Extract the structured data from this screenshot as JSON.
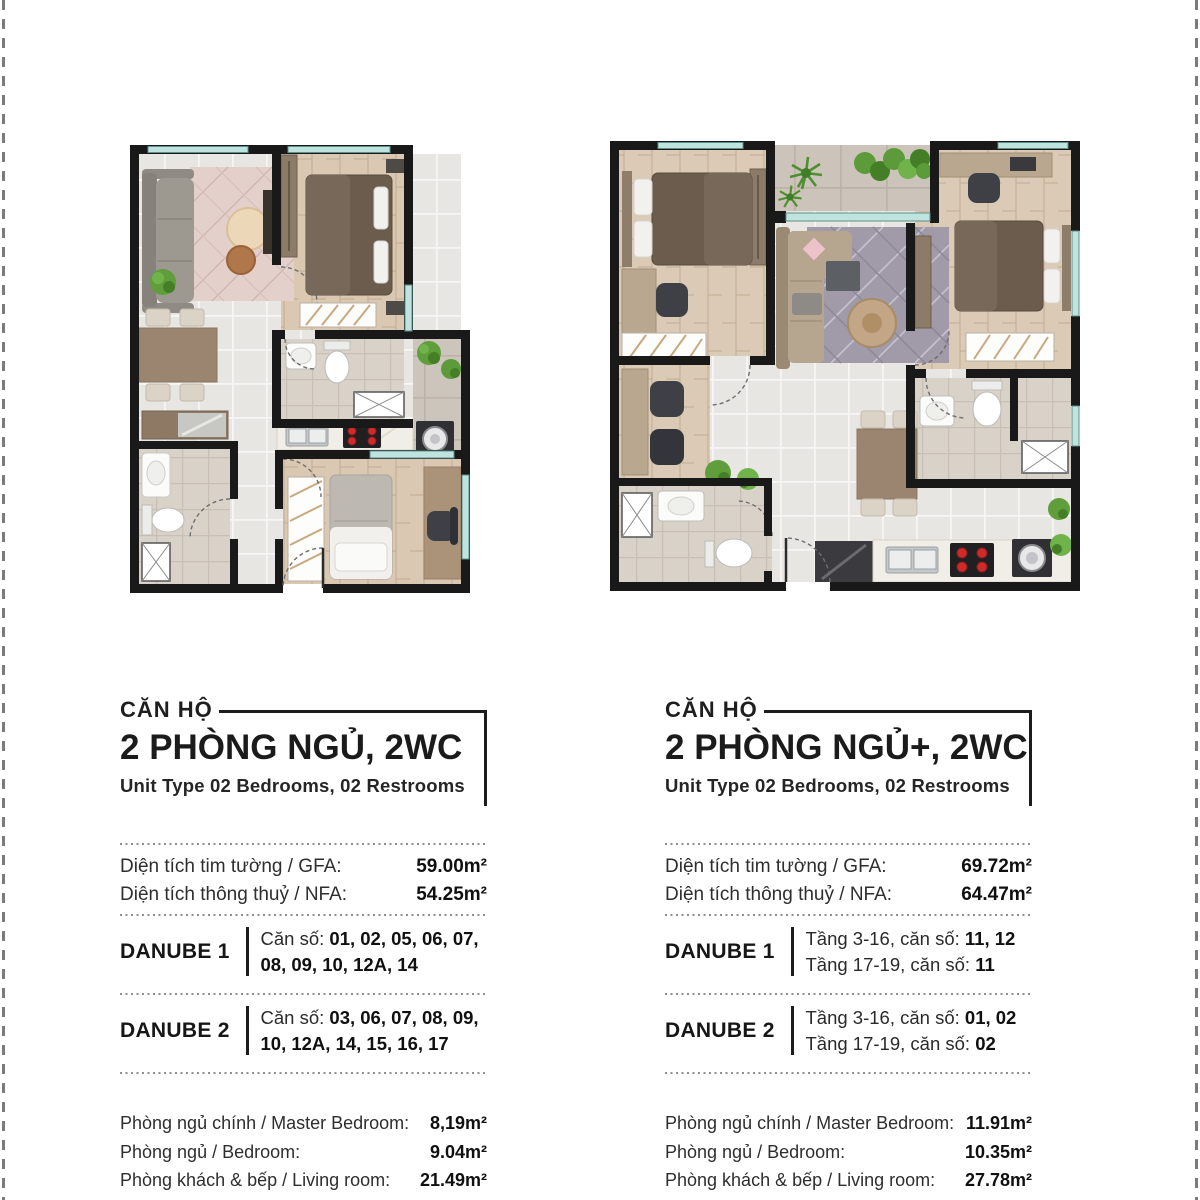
{
  "page": {
    "background": "#ffffff",
    "edge_dash_color": "#7b7b7b",
    "accent_wall_color": "#191919",
    "window_color": "#bfe4df",
    "stove_burner_color": "#d02a2a"
  },
  "units": [
    {
      "tag": "CĂN HỘ",
      "title": "2 PHÒNG NGỦ, 2WC",
      "subtitle": "Unit Type 02 Bedrooms, 02 Restrooms",
      "areas": [
        {
          "label": "Diện tích tim tường / GFA:",
          "value": "59.00m²"
        },
        {
          "label": "Diện tích thông thuỷ / NFA:",
          "value": "54.25m²"
        }
      ],
      "towers": [
        {
          "name": "DANUBE 1",
          "prefix": "Căn số: ",
          "units_bold": "01, 02, 05, 06, 07, 08, 09, 10, 12A, 14"
        },
        {
          "name": "DANUBE 2",
          "prefix": "Căn số: ",
          "units_bold": "03, 06, 07, 08, 09, 10, 12A, 14, 15, 16, 17"
        }
      ],
      "rooms": [
        {
          "label": "Phòng ngủ chính / Master Bedroom:",
          "value": "8,19m²"
        },
        {
          "label": "Phòng ngủ / Bedroom:",
          "value": "9.04m²"
        },
        {
          "label": "Phòng khách & bếp / Living room:",
          "value": "21.49m²"
        }
      ]
    },
    {
      "tag": "CĂN HỘ",
      "title": "2 PHÒNG NGỦ+, 2WC",
      "subtitle": "Unit Type 02 Bedrooms, 02 Restrooms",
      "areas": [
        {
          "label": "Diện tích tim tường / GFA:",
          "value": "69.72m²"
        },
        {
          "label": "Diện tích thông thuỷ / NFA:",
          "value": "64.47m²"
        }
      ],
      "towers": [
        {
          "name": "DANUBE 1",
          "lines": [
            {
              "prefix": "Tầng 3-16, căn số: ",
              "units_bold": "11, 12"
            },
            {
              "prefix": "Tầng 17-19, căn số: ",
              "units_bold": "11"
            }
          ]
        },
        {
          "name": "DANUBE 2",
          "lines": [
            {
              "prefix": "Tầng 3-16, căn số: ",
              "units_bold": "01, 02"
            },
            {
              "prefix": "Tầng 17-19, căn số: ",
              "units_bold": "02"
            }
          ]
        }
      ],
      "rooms": [
        {
          "label": "Phòng ngủ chính / Master Bedroom:",
          "value": "11.91m²"
        },
        {
          "label": "Phòng ngủ / Bedroom:",
          "value": "10.35m²"
        },
        {
          "label": "Phòng khách & bếp / Living room:",
          "value": "27.78m²"
        }
      ]
    }
  ]
}
